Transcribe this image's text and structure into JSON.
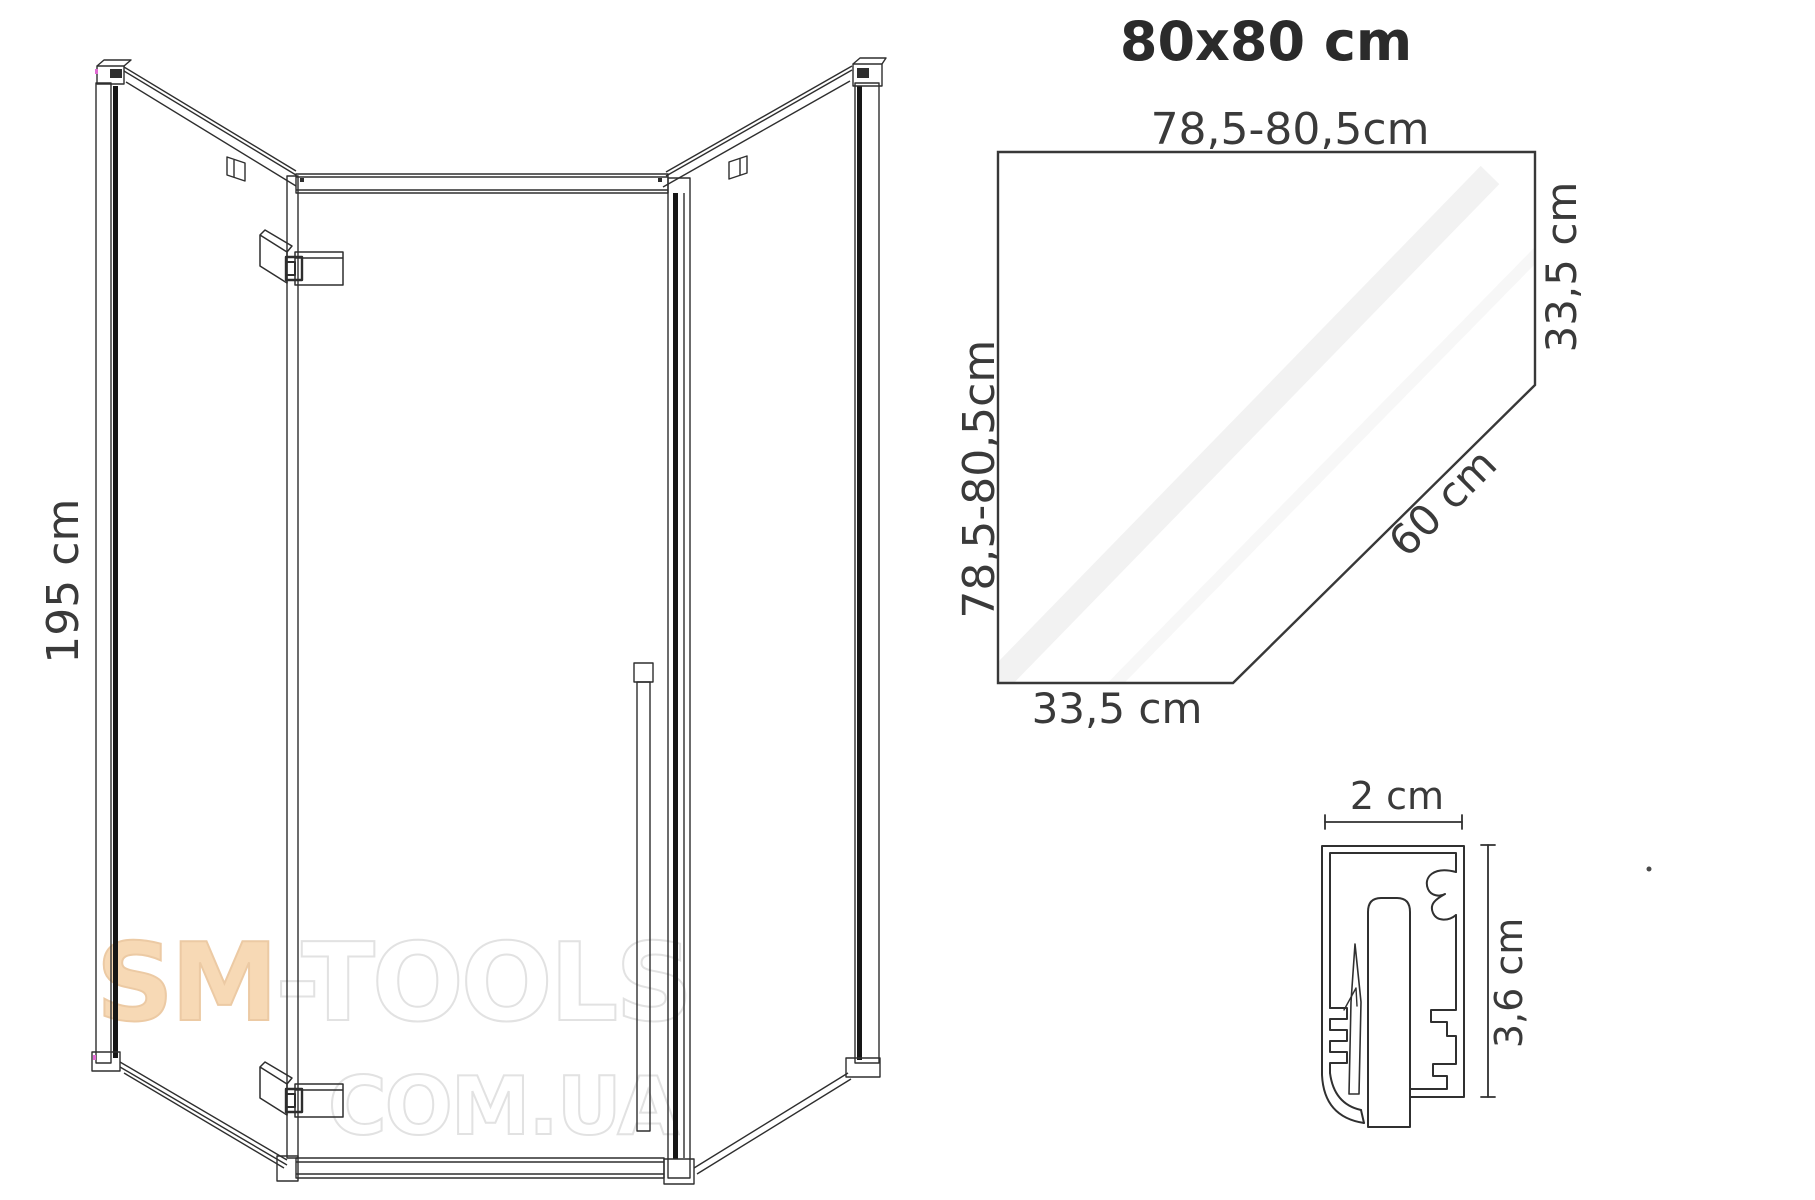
{
  "title": {
    "text": "80x80 cm"
  },
  "elevation": {
    "height_label": "195 cm"
  },
  "plan": {
    "top_label": "78,5-80,5cm",
    "left_label": "78,5-80,5cm",
    "right_label": "33,5 cm",
    "diagonal_label": "60 cm",
    "bottom_label": "33,5 cm"
  },
  "profile": {
    "width_label": "2 cm",
    "height_label": "3,6 cm"
  },
  "watermark": {
    "brand_accent": "SM",
    "brand_rest": "-TOOLS",
    "line2": "COM.UA",
    "accent_color": "#f7d9b5",
    "outline_color": "#e2e2e2"
  },
  "colors": {
    "line": "#2e2e2e",
    "plan_line": "#383838",
    "dimension_text": "#3a3a3a",
    "glass_edge": "#161616"
  }
}
